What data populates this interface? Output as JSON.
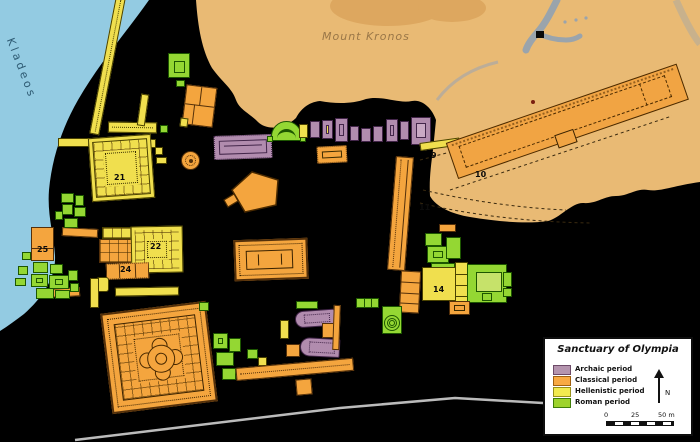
{
  "map": {
    "river_label": "Kladeos",
    "mountain_label": "Mount Kronos",
    "numbers": {
      "n9": "9",
      "n10": "10",
      "n11": "11",
      "n14": "14",
      "n21": "21",
      "n22": "22",
      "n24": "24",
      "n25": "25"
    }
  },
  "legend": {
    "title": "Sanctuary of Olympia",
    "items": [
      {
        "label": "Archaic period",
        "color": "#b494ae"
      },
      {
        "label": "Classical period",
        "color": "#f8a943"
      },
      {
        "label": "Hellenistic period",
        "color": "#f2ea4f"
      },
      {
        "label": "Roman period",
        "color": "#9ed32c"
      }
    ],
    "north_label": "N",
    "scale": {
      "zero": "0",
      "mid": "25",
      "end": "50 m"
    }
  },
  "colors": {
    "background": "#000000",
    "river": "#93cbe2",
    "terrain": "#e9ba74",
    "terrain_summit": "#dda75f",
    "archaic": "#b18cae",
    "classical": "#f4a53e",
    "hellenistic": "#f0df4e",
    "roman": "#94d733"
  }
}
